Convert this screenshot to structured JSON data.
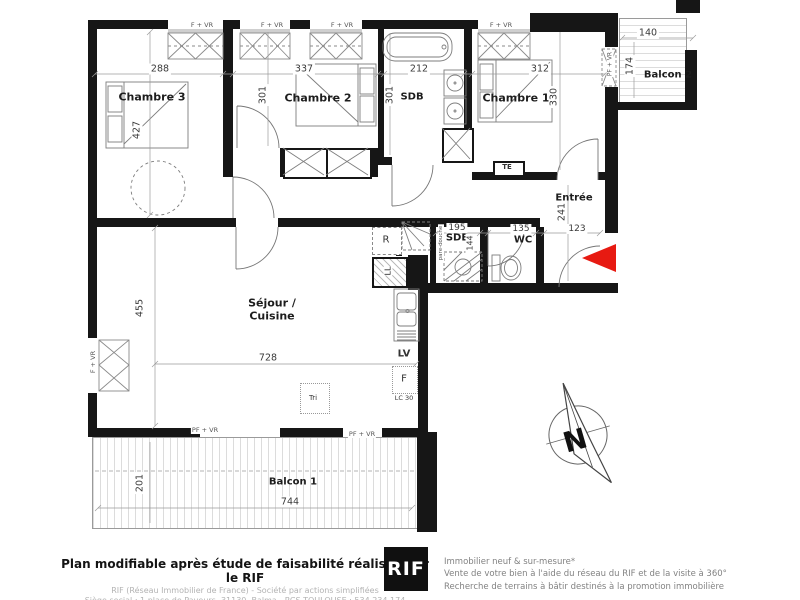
{
  "plan": {
    "windows": {
      "f_vr": "F + VR",
      "pf_vr": "PF + VR"
    },
    "rooms": {
      "chambre3": {
        "name": "Chambre 3",
        "w": "288",
        "h": "427"
      },
      "chambre2": {
        "name": "Chambre 2",
        "w": "337",
        "h": "301"
      },
      "sdb": {
        "name": "SDB",
        "w": "212",
        "h": "301"
      },
      "chambre1": {
        "name": "Chambre 1",
        "w": "312",
        "h": "330"
      },
      "balcon2": {
        "name": "Balcon 2",
        "w": "140",
        "h": "174"
      },
      "entree": {
        "name": "Entrée",
        "w": "123",
        "h": "241"
      },
      "sde": {
        "name": "SDE",
        "w": "195",
        "h": "144",
        "screen": "pare-douche"
      },
      "wc": {
        "name": "WC",
        "w": "135"
      },
      "sejour": {
        "name1": "Séjour /",
        "name2": "Cuisine",
        "w": "728",
        "h": "455"
      },
      "balcon1": {
        "name": "Balcon 1",
        "w": "744",
        "h": "201"
      }
    },
    "equipment": {
      "te": "TE",
      "r": "R",
      "ll": "LL",
      "lv": "LV",
      "f": "F",
      "lc30": "LC 30",
      "tri": "Tri"
    },
    "compass_n": "N",
    "entrance_arrow_color": "#e71a12"
  },
  "footer": {
    "left": {
      "line1": "Plan modifiable après étude de faisabilité réalisée par le RIF",
      "line2": "RIF (Réseau Immobilier de France) - Société par actions simplifiées",
      "line3": "Siège social : 1 place de Paveurs, 31130, Balma - RCS TOULOUSE : 534 234 174"
    },
    "logo": "RIF",
    "right": {
      "line1": "Immobilier neuf & sur-mesure*",
      "line2": "Vente de votre bien à l'aide du réseau du RIF et de la visite à 360°",
      "line3": "Recherche de terrains à bâtir destinés à la promotion immobilière"
    }
  }
}
